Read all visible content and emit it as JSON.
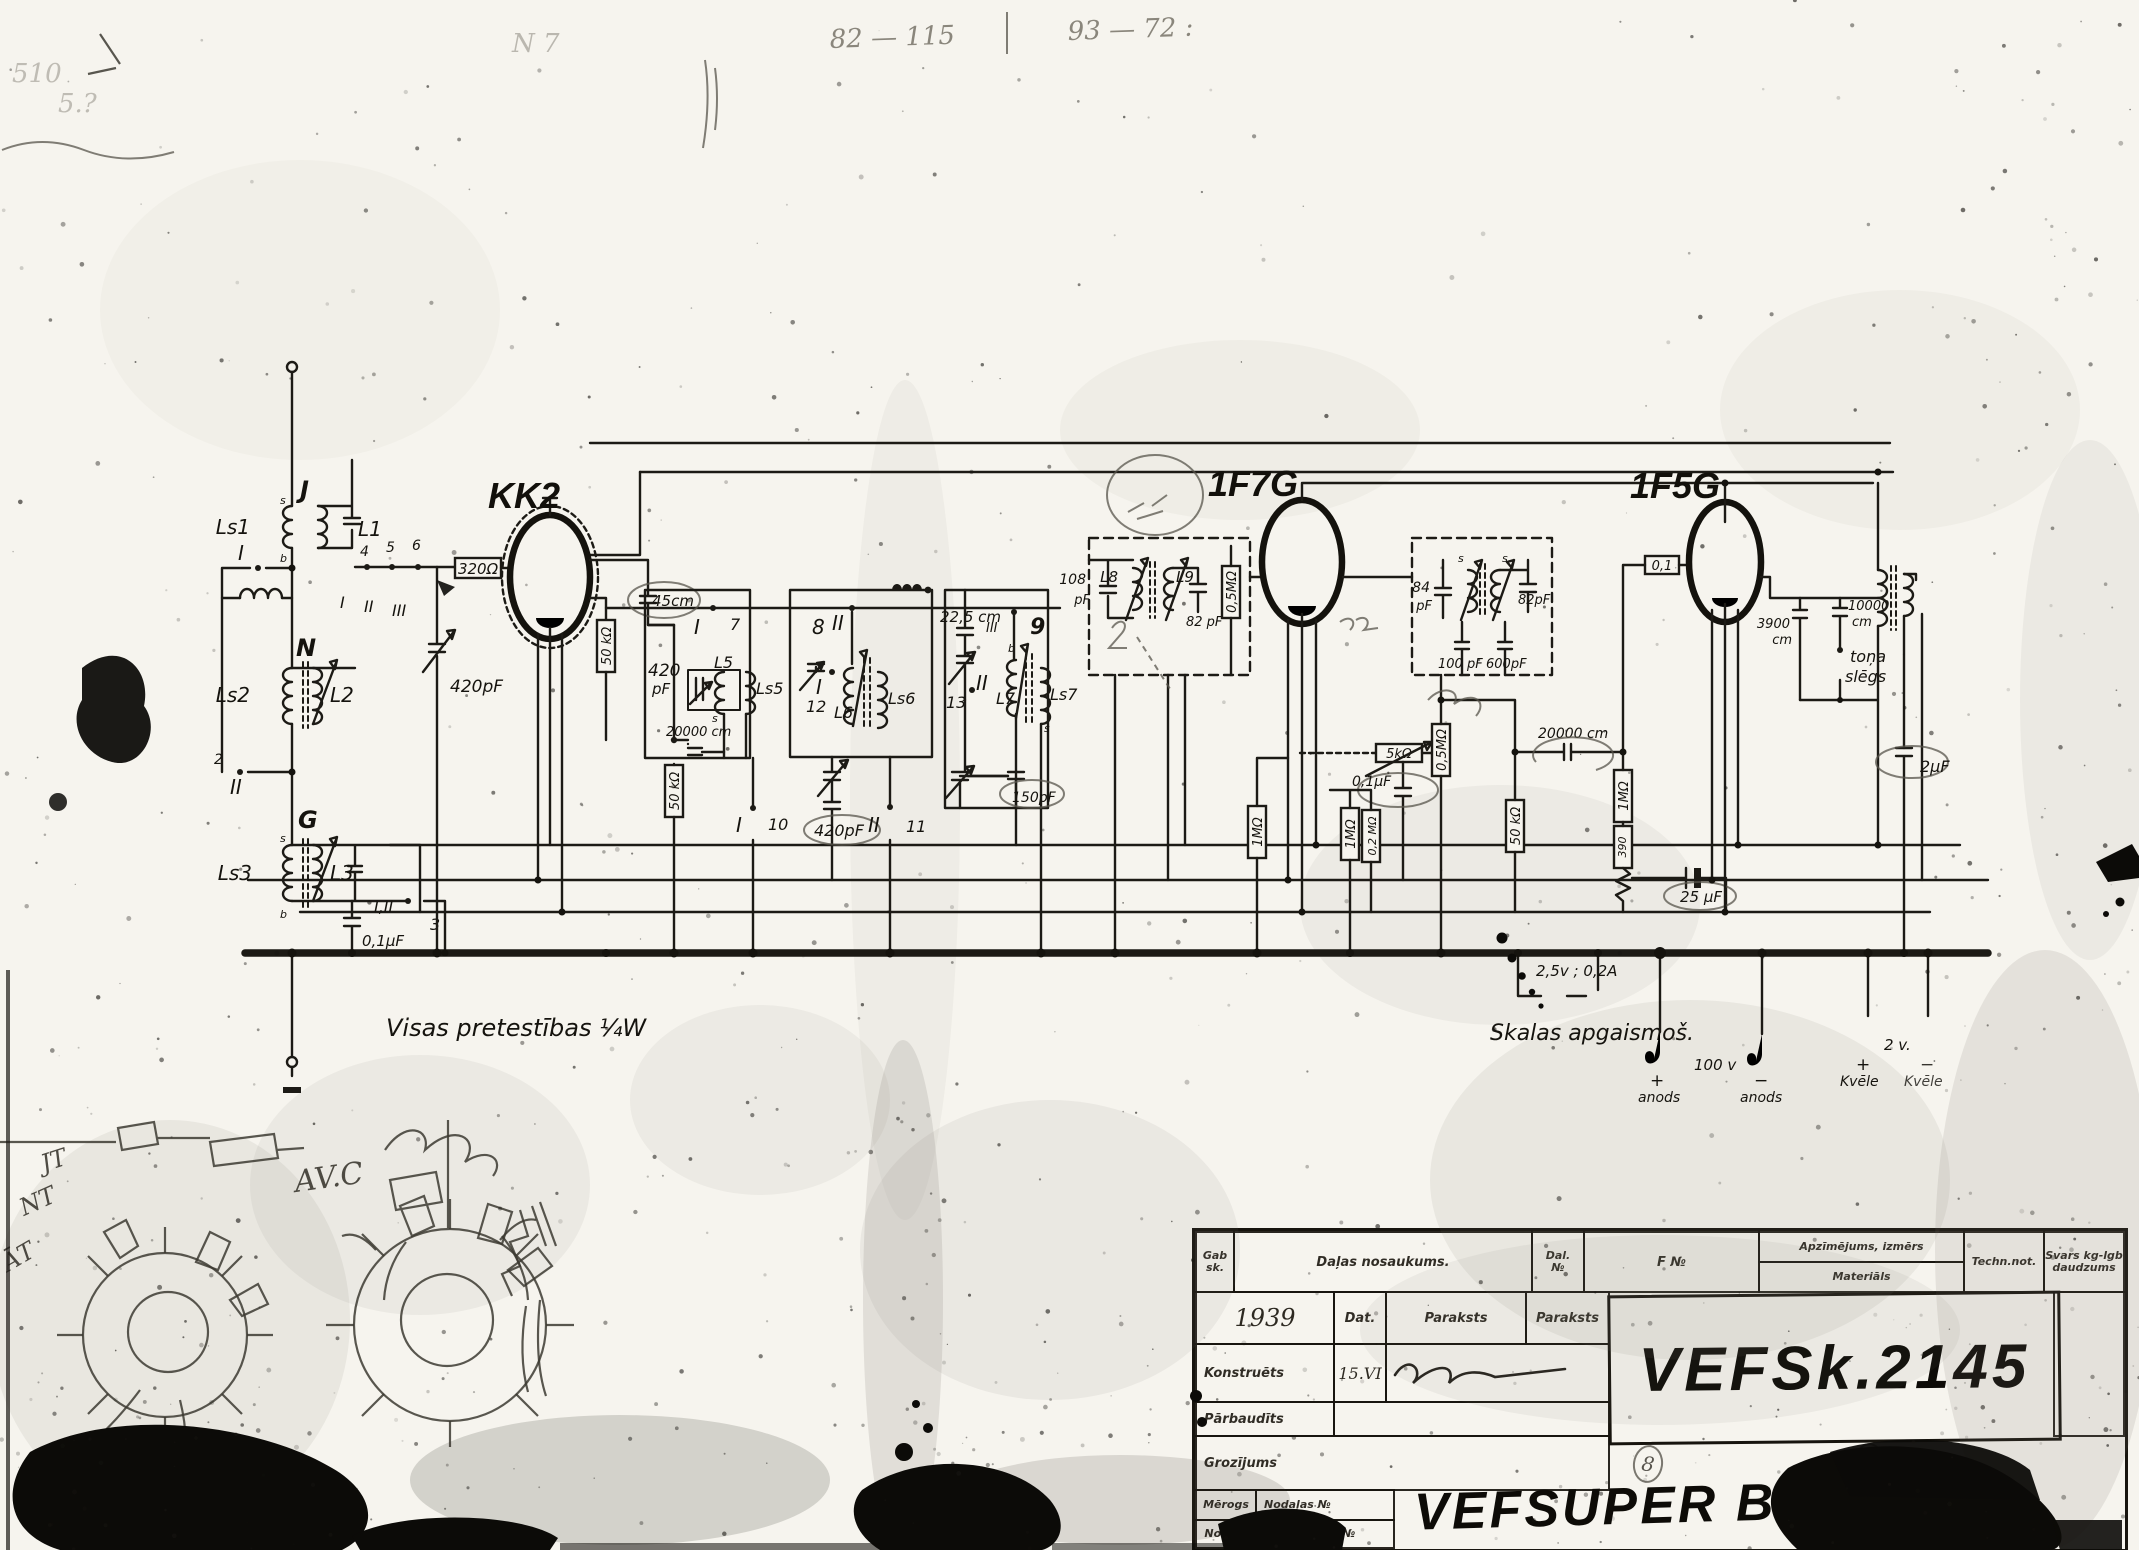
{
  "tubes": {
    "converter": "KK2",
    "if_amp": "1F7G",
    "output": "1F5G"
  },
  "labels": {
    "j": "J",
    "ls1": "Ls1",
    "l1": "L1",
    "sw_i": "I",
    "n": "N",
    "ls2": "Ls2",
    "l2": "L2",
    "sw_ii": "II",
    "sw_ii_num": "2",
    "g": "G",
    "ls3": "Ls3",
    "l3": "L3",
    "sw_iii_lbl": "I,II",
    "sw_iii_num": "3",
    "c01_input": "0,1µF",
    "r320": "320Ω",
    "bs4": "4",
    "bs5": "5",
    "bs6": "6",
    "bsI": "I",
    "bsII": "II",
    "bsIII": "III",
    "c420_tune1": "420pF",
    "c45": "45cm",
    "r50_1": "50 kΩ",
    "c420_pad_v": "420",
    "c420_pad_u": "pF",
    "r50_2": "50 kΩ",
    "c20000_1": "20000 cm",
    "sw7_l": "I",
    "sw7_n": "7",
    "l5": "L5",
    "ls5": "Ls5",
    "sw10_l": "I",
    "sw10_n": "10",
    "sw8_n": "8",
    "sw8_l": "II",
    "sw12_l": "I",
    "sw12_n": "12",
    "l6": "L6",
    "ls6": "Ls6",
    "c420_tune2": "420pF",
    "sw11_l": "II",
    "sw11_n": "11",
    "c225": "22,5 cm",
    "sw13_n": "13",
    "sw13_l": "II",
    "sw9_l": "III",
    "sw9_n": "9",
    "l7": "L7",
    "ls7": "Ls7",
    "c150": "150pF",
    "c108_v": "108",
    "c108_u": "pF",
    "l8": "L8",
    "l9": "L9",
    "c82_1": "82 pF",
    "r05_1": "0,5MΩ",
    "c84_v": "84",
    "c84_u": "pF",
    "c82_2": "82pF",
    "c100": "100 pF",
    "c600": "600pF",
    "r5k": "5kΩ",
    "r05_2": "0,5MΩ",
    "c01_av": "0,1µF",
    "r1m_1": "1MΩ",
    "r1m_2": "1MΩ",
    "r02m": "0,2 MΩ",
    "r50_3": "50 kΩ",
    "c20000_2": "20000 cm",
    "r1m_3": "1MΩ",
    "r390": "390",
    "c25": "25 µF",
    "c01_g": "0,1",
    "c3900_v": "3900",
    "c3900_u": "cm",
    "c10000_v": "10000",
    "c10000_u": "cm",
    "tone_1": "toņa",
    "tone_2": "slēgs",
    "c2": "2µF",
    "pin_s": "s",
    "pin_b": "b"
  },
  "notes": {
    "resistors": "Visas  pretestības  ¼W",
    "lamp": "2,5v ; 0,2A",
    "dial": "Skalas  apgaismoš.",
    "v100": "100 v",
    "v2": "2 v.",
    "plus": "+",
    "minus": "−",
    "anods": "anods",
    "kvele": "Kvēle"
  },
  "handwriting": {
    "top_a": "82 — 115",
    "top_b": "93 — 72 :",
    "top_c": "N 7",
    "tl_a": "510",
    "tl_b": "5.?",
    "sk_jt": "JT",
    "sk_nt": "NT",
    "sk_at": "ĀT",
    "sk_avc": "AV.C"
  },
  "titleblock": {
    "gab": "Gab",
    "sk": "sk.",
    "dalas": "Daļas  nosaukums.",
    "dal": "Dal.",
    "nr": "№",
    "fnr": "F  №",
    "apz": "Apzīmējums, izmērs",
    "mat": "Materiāls",
    "techn": "Techn.not.",
    "svars": "Svars kg-lgb",
    "daudz": "daudzums",
    "year": "1939",
    "dat": "Dat.",
    "paraksts1": "Paraksts",
    "paraksts2": "Paraksts",
    "konstr": "Konstruēts",
    "kdate": "15.VI",
    "parb": "Pārbaudīts",
    "groz": "Grozījums",
    "m8a": "8",
    "m8b": "8",
    "merogs": "Mērogs",
    "nodalas": "Nodaļas №",
    "nodala": "Nodaļa",
    "ietilpst": "Ietilpst daļā №",
    "doc": "VEFSk.2145",
    "model": "VEFSUPER B306"
  }
}
